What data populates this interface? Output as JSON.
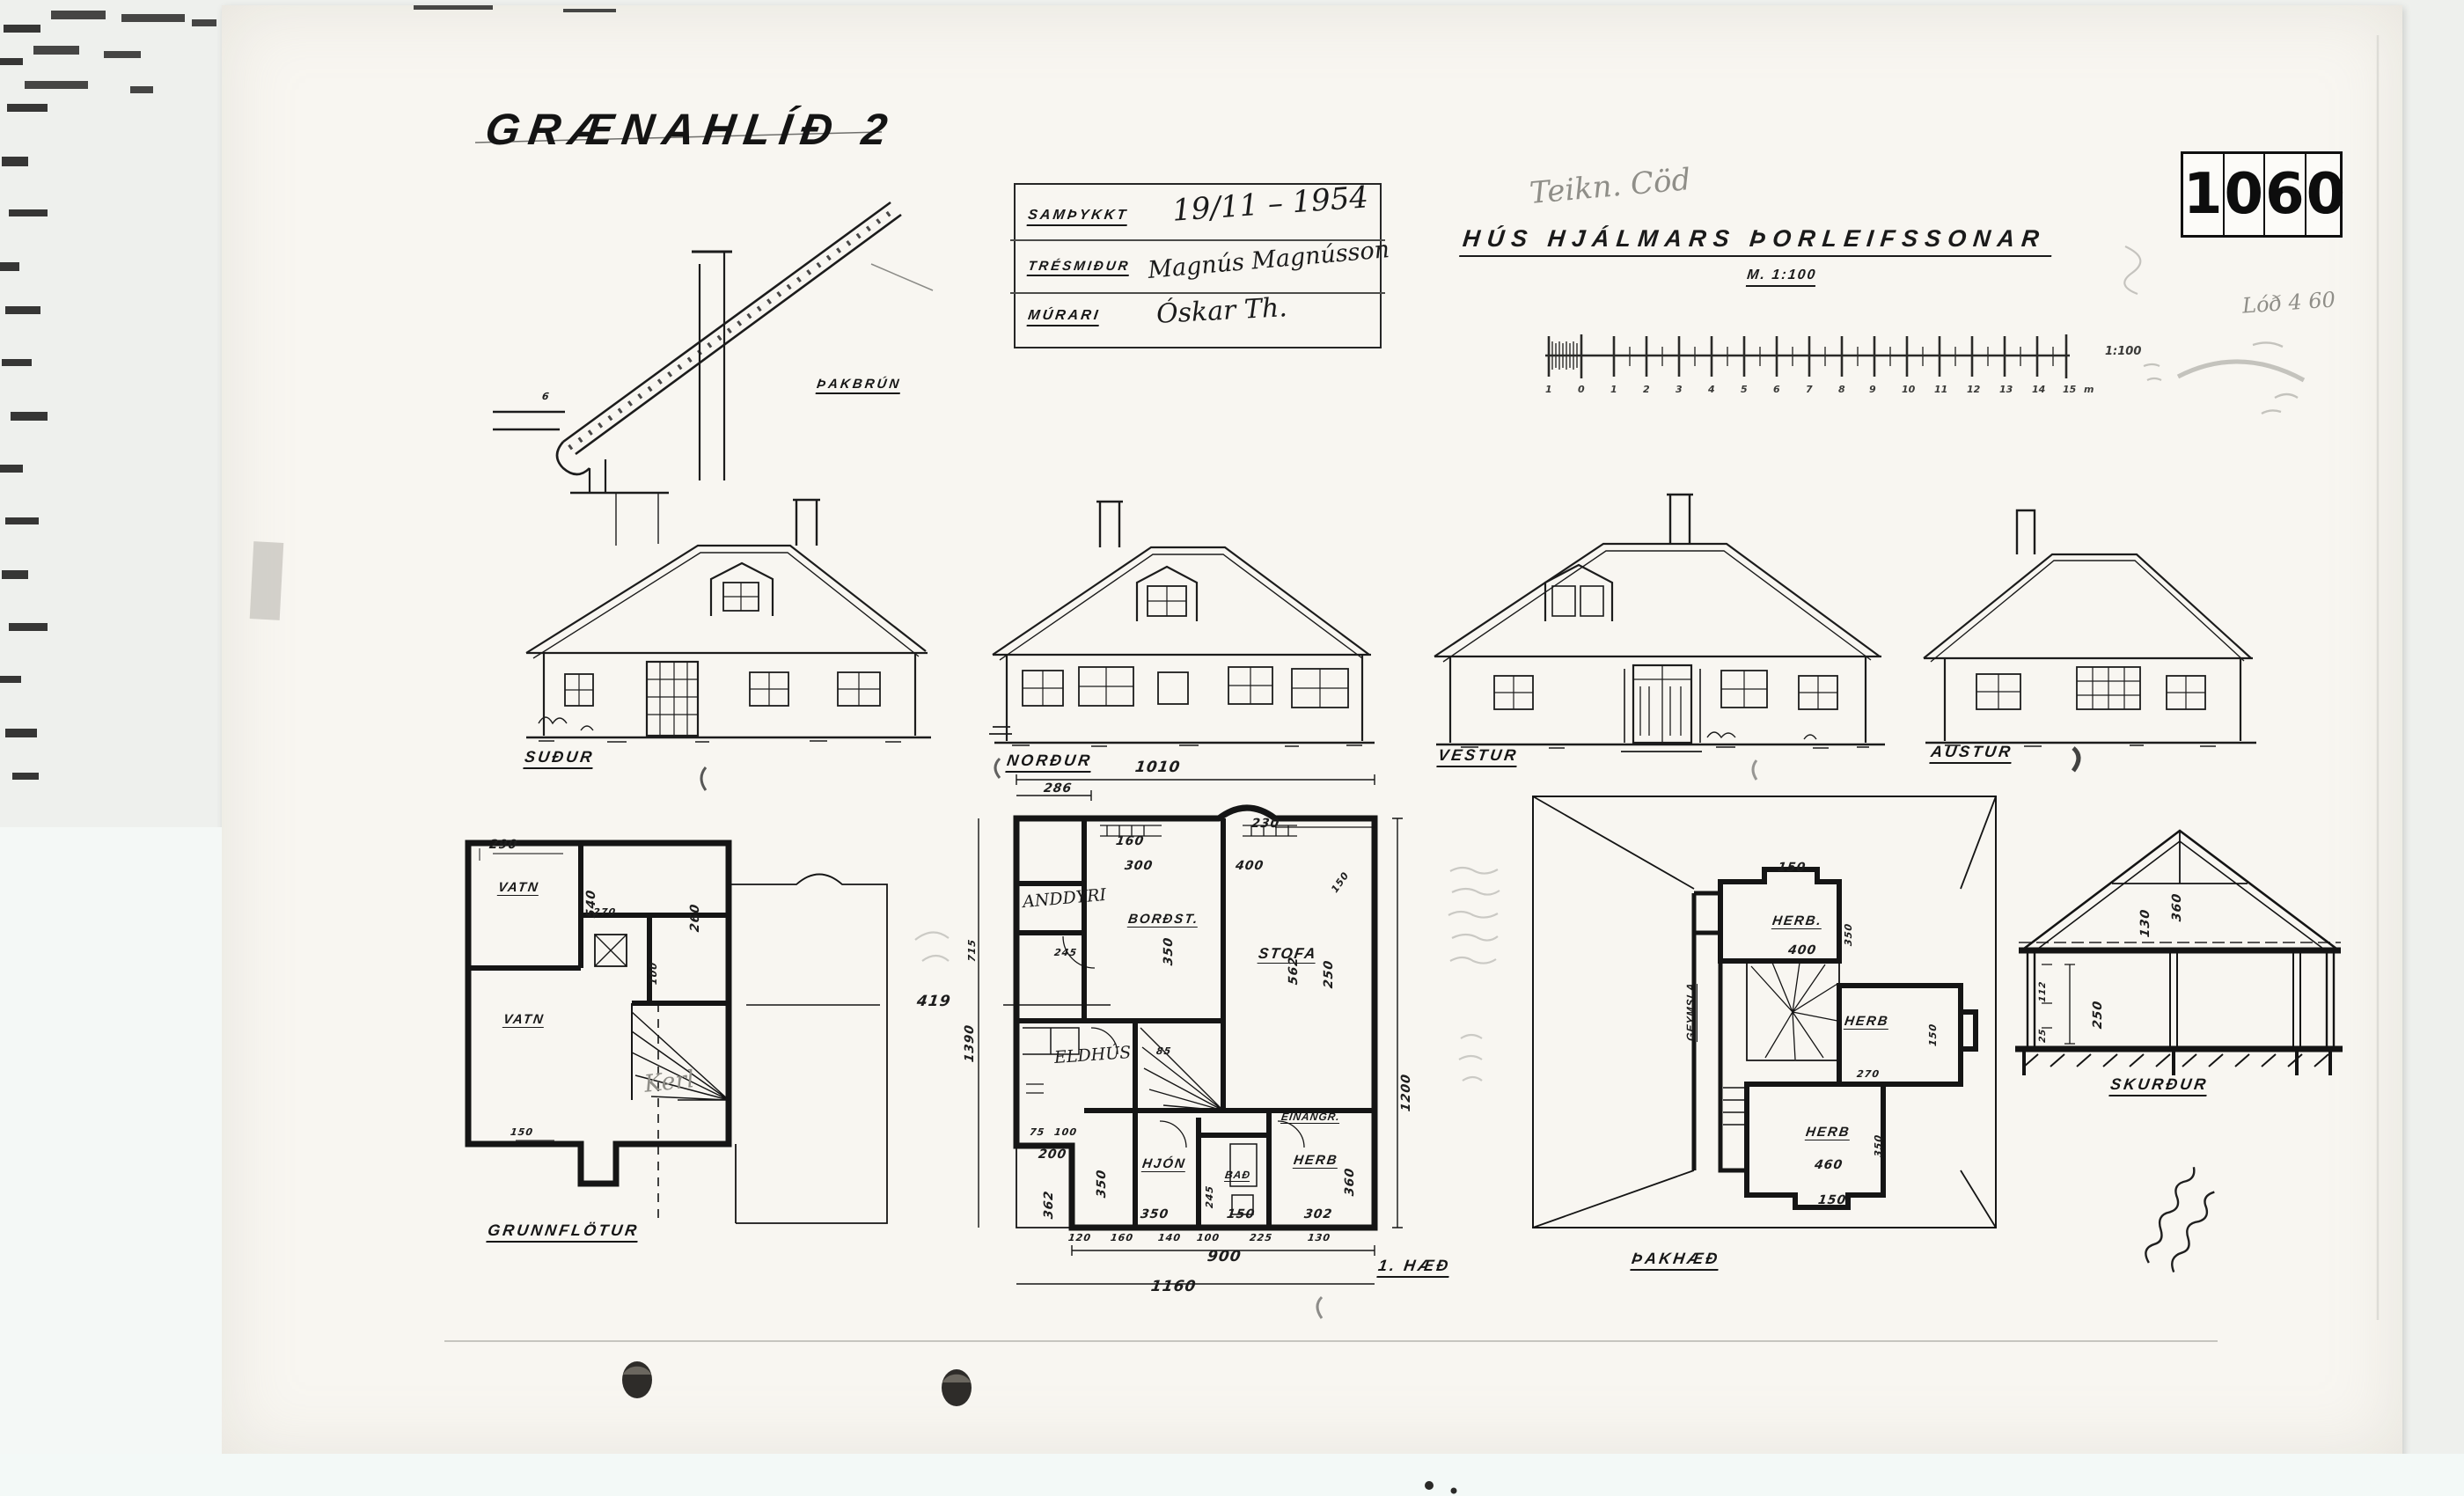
{
  "header": {
    "street": "GRÆNAHLÍÐ 2",
    "project_title": "HÚS HJÁLMARS ÞORLEIFSSONAR",
    "scale_note": "M. 1:100",
    "pencil_note": "Teikn. Cöd",
    "pencil_note2": "Lóð 4 60",
    "number_digits": [
      "1",
      "0",
      "6",
      "0"
    ]
  },
  "stamp": {
    "row1_label": "SAMÞYKKT",
    "row1_value": "19/11 – 1954",
    "row2_label": "TRÉSMIÐUR",
    "row2_value": "Magnús Magnússon",
    "row3_label": "MÚRARI",
    "row3_value": "Óskar Th."
  },
  "scalebar": {
    "ticks": [
      "1",
      "0",
      "1",
      "2",
      "3",
      "4",
      "5",
      "6",
      "7",
      "8",
      "9",
      "10",
      "11",
      "12",
      "13",
      "14",
      "15",
      "m"
    ],
    "ratio": "1:100"
  },
  "labels": {
    "south": "SUÐUR",
    "north": "NORÐUR",
    "west": "VESTUR",
    "east": "AUSTUR",
    "detail": "ÞAKBRÚN",
    "detail_dim": "6",
    "basement": "GRUNNFLÖTUR",
    "first": "1. HÆÐ",
    "attic": "ÞAKHÆÐ",
    "section": "SKURÐUR"
  },
  "rooms": {
    "basement": [
      "VATN",
      "VATN"
    ],
    "basement_pencil": "Kerl",
    "first": [
      "ANDDYRI",
      "BORÐST.",
      "STOFA",
      "ELDHÚS",
      "HJÓN",
      "BAÐ",
      "HERB",
      "EINANGR."
    ],
    "attic": [
      "HERB.",
      "HERB",
      "HERB",
      "GEYMSLA"
    ]
  },
  "dims": {
    "basement": [
      "290",
      "540",
      "260",
      "270",
      "100",
      "419",
      "150"
    ],
    "first": [
      "286",
      "1010",
      "230",
      "160",
      "300",
      "400",
      "150",
      "350",
      "562",
      "250",
      "245",
      "715",
      "1390",
      "1200",
      "85",
      "75",
      "100",
      "200",
      "362",
      "350",
      "245",
      "360",
      "350",
      "150",
      "302",
      "120",
      "160",
      "140",
      "100",
      "225",
      "130",
      "900",
      "1160"
    ],
    "attic": [
      "150",
      "400",
      "350",
      "150",
      "270",
      "350",
      "460",
      "150"
    ],
    "section": [
      "130",
      "360",
      "250",
      "25",
      "112"
    ]
  }
}
